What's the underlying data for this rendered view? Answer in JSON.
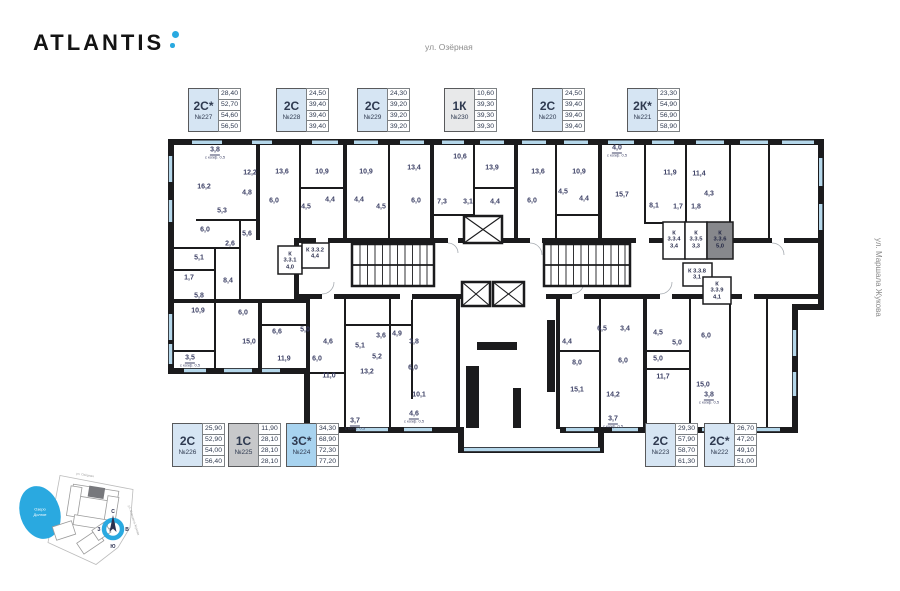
{
  "brand": {
    "name": "ATLANTIS"
  },
  "streets": {
    "top": "ул. Озёрная",
    "right": "ул. Маршала Жукова"
  },
  "compass": {
    "n": "С",
    "s": "Ю",
    "w": "З",
    "e": "В"
  },
  "minimap": {
    "lake_line1": "Озеро",
    "lake_line2": "Долгое"
  },
  "cards_top": [
    {
      "type": "2С*",
      "number": "№227",
      "x": 188,
      "variant": "blue",
      "values": [
        "28,40",
        "52,70",
        "54,60",
        "56,50"
      ]
    },
    {
      "type": "2С",
      "number": "№228",
      "x": 276,
      "variant": "blue",
      "values": [
        "24,50",
        "39,40",
        "39,40",
        "39,40"
      ]
    },
    {
      "type": "2С",
      "number": "№229",
      "x": 357,
      "variant": "blue",
      "values": [
        "24,30",
        "39,20",
        "39,20",
        "39,20"
      ]
    },
    {
      "type": "1К",
      "number": "№230",
      "x": 444,
      "variant": "gray",
      "values": [
        "10,60",
        "39,30",
        "39,30",
        "39,30"
      ]
    },
    {
      "type": "2С",
      "number": "№220",
      "x": 532,
      "variant": "blue",
      "values": [
        "24,50",
        "39,40",
        "39,40",
        "39,40"
      ]
    },
    {
      "type": "2К*",
      "number": "№221",
      "x": 627,
      "variant": "blue",
      "values": [
        "23,30",
        "54,90",
        "56,90",
        "58,90"
      ]
    }
  ],
  "cards_bottom": [
    {
      "type": "2С",
      "number": "№226",
      "x": 172,
      "variant": "blue",
      "values": [
        "25,90",
        "52,90",
        "54,00",
        "56,40"
      ]
    },
    {
      "type": "1С",
      "number": "№225",
      "x": 228,
      "variant": "grayDark",
      "values": [
        "11,90",
        "28,10",
        "28,10",
        "28,10"
      ]
    },
    {
      "type": "3С*",
      "number": "№224",
      "x": 286,
      "variant": "bright",
      "values": [
        "34,30",
        "68,90",
        "72,30",
        "77,20"
      ]
    },
    {
      "type": "2С",
      "number": "№223",
      "x": 645,
      "variant": "blue",
      "values": [
        "29,30",
        "57,90",
        "58,70",
        "61,30"
      ]
    },
    {
      "type": "2С*",
      "number": "№222",
      "x": 704,
      "variant": "blue",
      "values": [
        "26,70",
        "47,20",
        "49,10",
        "51,00"
      ]
    }
  ],
  "plan": {
    "rooms": [
      {
        "x": 215,
        "y": 153,
        "a": "3,8",
        "sub": "с коэф. 0,5"
      },
      {
        "x": 204,
        "y": 187,
        "a": "16,2"
      },
      {
        "x": 250,
        "y": 173,
        "a": "12,2"
      },
      {
        "x": 247,
        "y": 193,
        "a": "4,8"
      },
      {
        "x": 222,
        "y": 211,
        "a": "5,3"
      },
      {
        "x": 205,
        "y": 230,
        "a": "6,0"
      },
      {
        "x": 247,
        "y": 234,
        "a": "5,6"
      },
      {
        "x": 230,
        "y": 244,
        "a": "2,6"
      },
      {
        "x": 199,
        "y": 258,
        "a": "5,1"
      },
      {
        "x": 189,
        "y": 278,
        "a": "1,7"
      },
      {
        "x": 228,
        "y": 281,
        "a": "8,4"
      },
      {
        "x": 199,
        "y": 296,
        "a": "5,8"
      },
      {
        "x": 282,
        "y": 172,
        "a": "13,6"
      },
      {
        "x": 274,
        "y": 201,
        "a": "6,0"
      },
      {
        "x": 306,
        "y": 207,
        "a": "4,5"
      },
      {
        "x": 322,
        "y": 172,
        "a": "10,9"
      },
      {
        "x": 330,
        "y": 200,
        "a": "4,4"
      },
      {
        "x": 366,
        "y": 172,
        "a": "10,9"
      },
      {
        "x": 359,
        "y": 200,
        "a": "4,4"
      },
      {
        "x": 381,
        "y": 207,
        "a": "4,5"
      },
      {
        "x": 414,
        "y": 168,
        "a": "13,4"
      },
      {
        "x": 460,
        "y": 157,
        "a": "10,6"
      },
      {
        "x": 492,
        "y": 168,
        "a": "13,9"
      },
      {
        "x": 416,
        "y": 201,
        "a": "6,0"
      },
      {
        "x": 442,
        "y": 202,
        "a": "7,3"
      },
      {
        "x": 468,
        "y": 202,
        "a": "3,1"
      },
      {
        "x": 495,
        "y": 202,
        "a": "4,4"
      },
      {
        "x": 538,
        "y": 172,
        "a": "13,6"
      },
      {
        "x": 532,
        "y": 201,
        "a": "6,0"
      },
      {
        "x": 579,
        "y": 172,
        "a": "10,9"
      },
      {
        "x": 563,
        "y": 192,
        "a": "4,5"
      },
      {
        "x": 584,
        "y": 199,
        "a": "4,4"
      },
      {
        "x": 617,
        "y": 151,
        "a": "4,0",
        "sub": "с коэф. 0,5"
      },
      {
        "x": 622,
        "y": 195,
        "a": "15,7"
      },
      {
        "x": 654,
        "y": 206,
        "a": "8,1"
      },
      {
        "x": 670,
        "y": 173,
        "a": "11,9"
      },
      {
        "x": 699,
        "y": 174,
        "a": "11,4"
      },
      {
        "x": 678,
        "y": 207,
        "a": "1,7"
      },
      {
        "x": 696,
        "y": 207,
        "a": "1,8"
      },
      {
        "x": 709,
        "y": 194,
        "a": "4,3"
      },
      {
        "x": 198,
        "y": 311,
        "a": "10,9"
      },
      {
        "x": 243,
        "y": 313,
        "a": "6,0"
      },
      {
        "x": 249,
        "y": 342,
        "a": "15,0"
      },
      {
        "x": 190,
        "y": 361,
        "a": "3,5",
        "sub": "с коэф. 0,5"
      },
      {
        "x": 277,
        "y": 332,
        "a": "6,6"
      },
      {
        "x": 305,
        "y": 330,
        "a": "5,0"
      },
      {
        "x": 284,
        "y": 359,
        "a": "11,9"
      },
      {
        "x": 328,
        "y": 342,
        "a": "4,6"
      },
      {
        "x": 317,
        "y": 359,
        "a": "6,0"
      },
      {
        "x": 329,
        "y": 376,
        "a": "11,0"
      },
      {
        "x": 381,
        "y": 336,
        "a": "3,6"
      },
      {
        "x": 397,
        "y": 334,
        "a": "4,9"
      },
      {
        "x": 360,
        "y": 346,
        "a": "5,1"
      },
      {
        "x": 377,
        "y": 357,
        "a": "5,2"
      },
      {
        "x": 367,
        "y": 372,
        "a": "13,2"
      },
      {
        "x": 355,
        "y": 424,
        "a": "3,7",
        "sub": "с коэф. 0,5"
      },
      {
        "x": 414,
        "y": 342,
        "a": "3,8"
      },
      {
        "x": 413,
        "y": 368,
        "a": "6,0"
      },
      {
        "x": 419,
        "y": 395,
        "a": "10,1"
      },
      {
        "x": 414,
        "y": 417,
        "a": "4,6",
        "sub": "с коэф. 0,5"
      },
      {
        "x": 567,
        "y": 342,
        "a": "4,4"
      },
      {
        "x": 602,
        "y": 329,
        "a": "6,5"
      },
      {
        "x": 625,
        "y": 329,
        "a": "3,4"
      },
      {
        "x": 577,
        "y": 363,
        "a": "8,0"
      },
      {
        "x": 577,
        "y": 390,
        "a": "15,1"
      },
      {
        "x": 623,
        "y": 361,
        "a": "6,0"
      },
      {
        "x": 613,
        "y": 395,
        "a": "14,2"
      },
      {
        "x": 613,
        "y": 422,
        "a": "3,7",
        "sub": "с коэф. 0,5"
      },
      {
        "x": 658,
        "y": 333,
        "a": "4,5"
      },
      {
        "x": 677,
        "y": 343,
        "a": "5,0"
      },
      {
        "x": 706,
        "y": 336,
        "a": "6,0"
      },
      {
        "x": 658,
        "y": 359,
        "a": "5,0"
      },
      {
        "x": 663,
        "y": 377,
        "a": "11,7"
      },
      {
        "x": 703,
        "y": 385,
        "a": "15,0"
      },
      {
        "x": 709,
        "y": 398,
        "a": "3,8",
        "sub": "с коэф. 0,5"
      }
    ],
    "storage": [
      {
        "x": 290,
        "y": 261,
        "lines": [
          "К",
          "3.3.1",
          "4,0"
        ]
      },
      {
        "x": 315,
        "y": 254,
        "lines": [
          "К 3.3.2",
          "4,4"
        ]
      },
      {
        "x": 674,
        "y": 240,
        "lines": [
          "К",
          "3.3.4",
          "3,4"
        ]
      },
      {
        "x": 696,
        "y": 240,
        "lines": [
          "К",
          "3.3.5",
          "3,3"
        ]
      },
      {
        "x": 720,
        "y": 240,
        "lines": [
          "К",
          "3.3.6",
          "5,0"
        ],
        "dark": true
      },
      {
        "x": 697,
        "y": 275,
        "lines": [
          "К 3.3.8",
          "3,1"
        ]
      },
      {
        "x": 717,
        "y": 291,
        "lines": [
          "К",
          "3.3.9",
          "4,1"
        ]
      }
    ]
  }
}
